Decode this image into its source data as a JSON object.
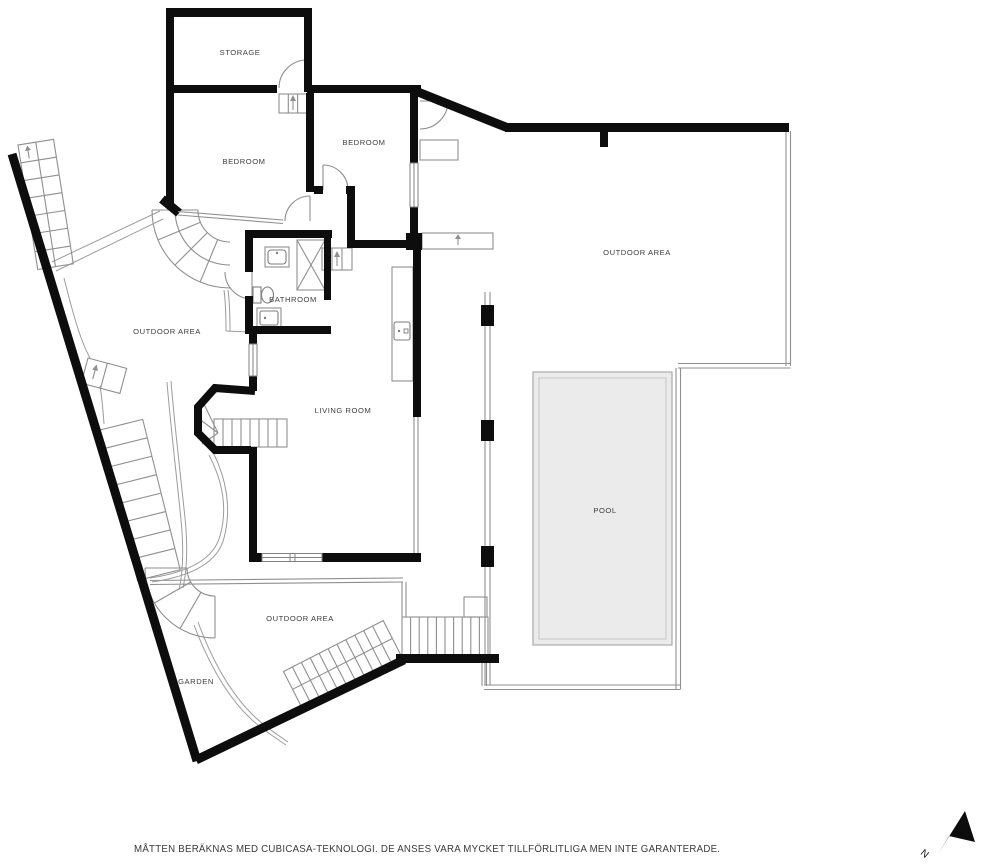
{
  "rooms": {
    "storage": "STORAGE",
    "bedroom_left": "BEDROOM",
    "bedroom_right": "BEDROOM",
    "bathroom": "BATHROOM",
    "living_room": "LIVING ROOM",
    "pool": "POOL",
    "outdoor_left": "OUTDOOR AREA",
    "outdoor_right": "OUTDOOR AREA",
    "outdoor_bottom": "OUTDOOR AREA",
    "garden": "GARDEN"
  },
  "footer": {
    "disclaimer": "MÅTTEN BERÄKNAS MED CUBICASA-TEKNOLOGI. DE ANSES VARA MYCKET TILLFÖRLITLIGA MEN INTE GARANTERADE."
  },
  "compass": {
    "north_label": "N"
  },
  "colors": {
    "wall": "#0d0d0d",
    "thin_line": "#8f8f8f",
    "path_line": "#9c9c9c",
    "pool_fill": "#ebebeb",
    "pool_border": "#b0b0b0",
    "label": "#3d3d3d",
    "background": "#ffffff"
  }
}
